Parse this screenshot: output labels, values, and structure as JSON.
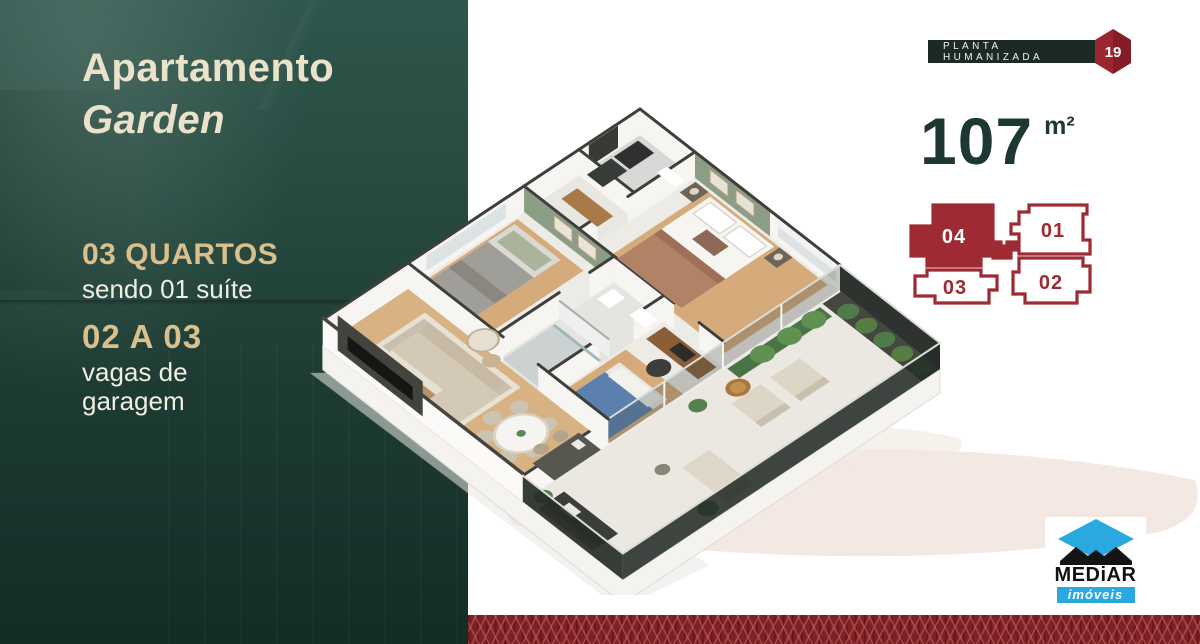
{
  "panel": {
    "title_line1": "Apartamento",
    "title_line2": "Garden",
    "features": [
      {
        "title": "03 QUARTOS",
        "subtitle": "sendo 01 suíte"
      },
      {
        "title": "02 A 03",
        "subtitle": "vagas de garagem"
      }
    ]
  },
  "badge": {
    "label": "PLANTA HUMANIZADA",
    "number": "19"
  },
  "area": {
    "value": "107",
    "unit": "m²"
  },
  "units": {
    "active": "04",
    "labels": {
      "u01": "01",
      "u02": "02",
      "u03": "03",
      "u04": "04"
    }
  },
  "logo": {
    "name": "MEDiAR",
    "tagline": "imóveis"
  },
  "colors": {
    "panel_teal": "#1d3b33",
    "accent_gold": "#d9c08c",
    "cream": "#eae2cb",
    "brand_red": "#9e2a33",
    "deep_green": "#1d3833",
    "strip_red": "#7c2127",
    "swoosh_beige": "#f3e9e2",
    "accent_wall_green": "#8c9d85"
  }
}
